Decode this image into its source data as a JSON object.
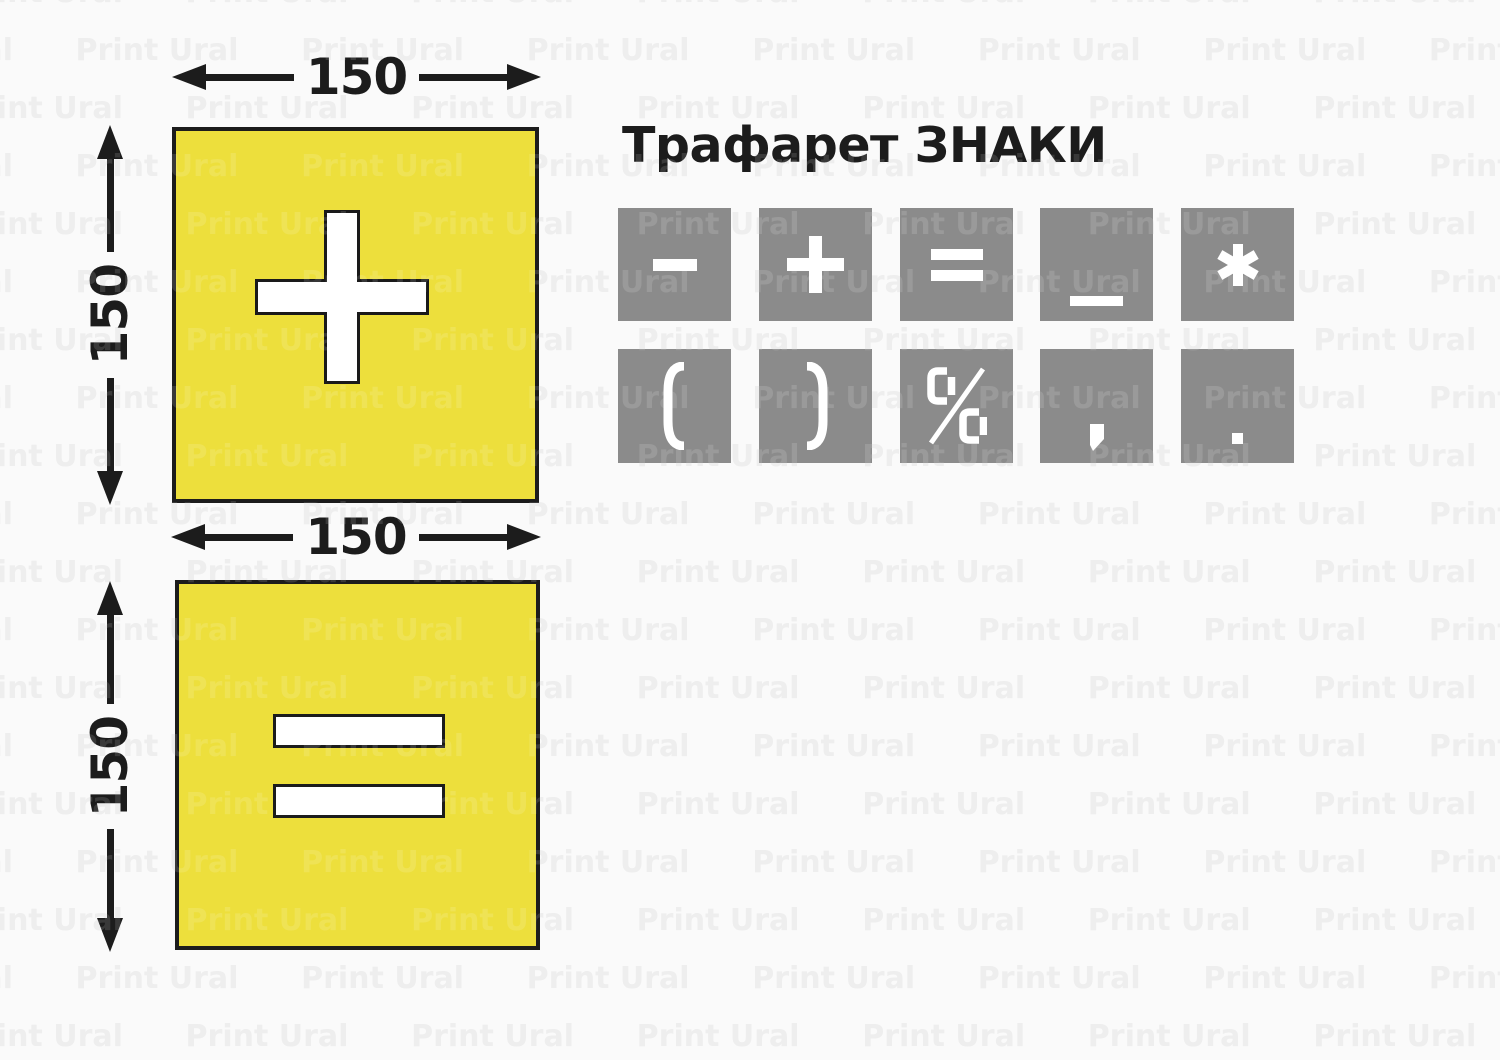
{
  "title": "Трафарет ЗНАКИ",
  "watermark": {
    "text": "Print Ural"
  },
  "dimensions": {
    "top_square_width": "150",
    "top_square_height": "150",
    "bottom_square_width": "150",
    "bottom_square_height": "150"
  },
  "stencil_squares": [
    {
      "symbol": "plus",
      "fill": "#EDDF3C"
    },
    {
      "symbol": "equals",
      "fill": "#EDDF3C"
    }
  ],
  "sign_grid": {
    "tile_color": "#8B8B8B",
    "glyph_color": "#FFFFFF",
    "rows": [
      [
        "minus",
        "plus",
        "equals",
        "underscore",
        "asterisk"
      ],
      [
        "paren-open",
        "paren-close",
        "percent",
        "comma",
        "period"
      ]
    ]
  },
  "colors": {
    "background": "#FAFAFA",
    "ink": "#1C1C1C",
    "yellow": "#EDDF3C",
    "tile_gray": "#8B8B8B",
    "watermark_gray": "#ECECEC"
  }
}
